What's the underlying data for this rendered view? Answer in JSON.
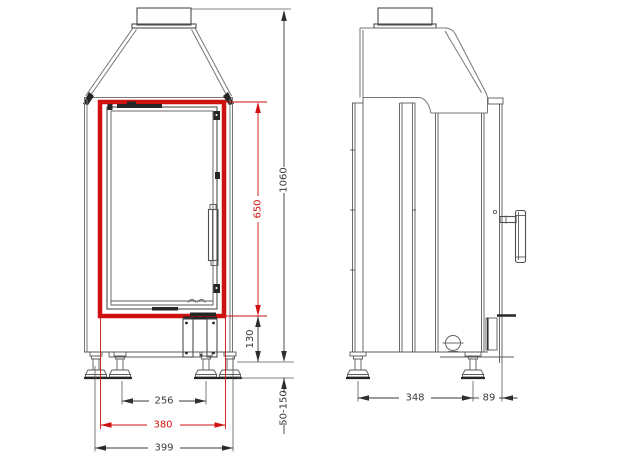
{
  "drawing": {
    "background_color": "#ffffff",
    "line_color": "#4d4d4d",
    "accent_color": "#cf1111",
    "dimensions": {
      "overall_height": "1060",
      "door_opening_height": "650",
      "base_section_height": "130",
      "foot_adjustment_range": "50-150",
      "inner_feet_spacing": "256",
      "highlight_frame_width": "380",
      "overall_width": "399",
      "feet_depth_spacing": "348",
      "rear_overhang": "89"
    }
  }
}
